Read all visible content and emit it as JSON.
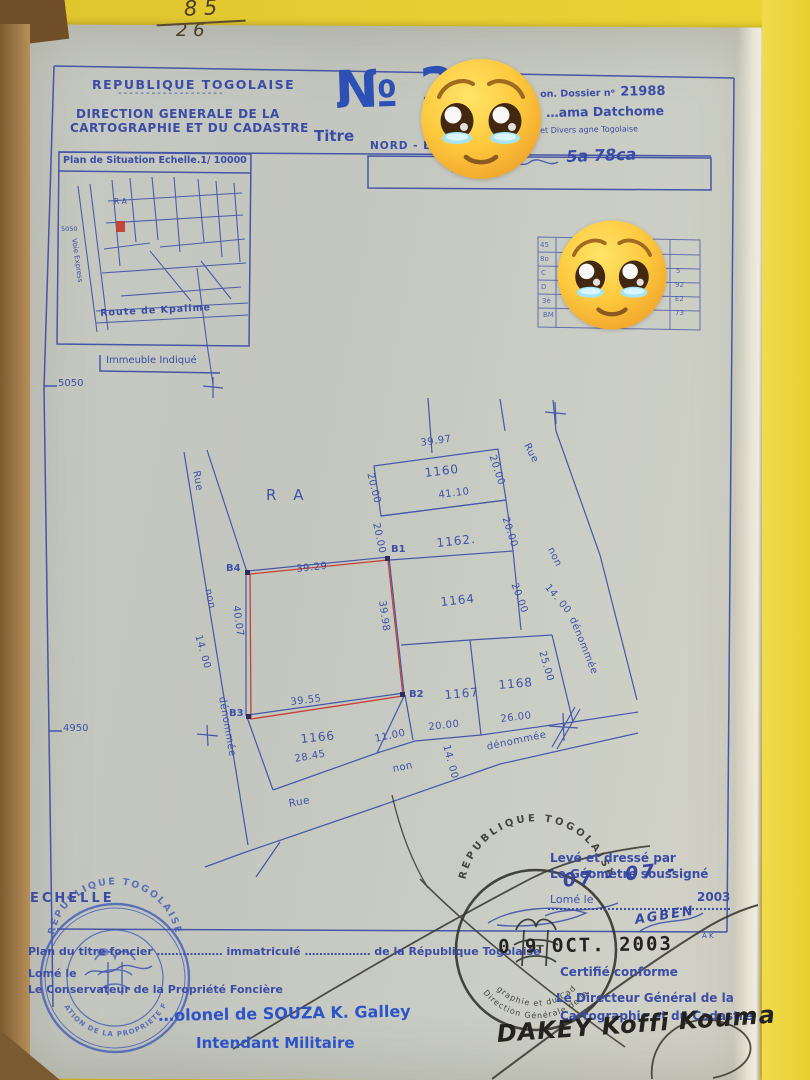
{
  "photo": {
    "note_line1": "8 5",
    "note_line2": "2 6"
  },
  "header": {
    "republic": "REPUBLIQUE  TOGOLAISE",
    "underline": "-------------------",
    "direction1": "DIRECTION  GENERALE  DE  LA",
    "direction2": "CARTOGRAPHIE  ET  DU  CADASTRE",
    "titre": "Titre",
    "number": "№ 2",
    "dossier_prefix": "on. Dossier nᵒ",
    "dossier_number": "21988",
    "holder_line": "…ama  Datchome",
    "holder_line2": "et Divers agne Togolaise",
    "nord": "NORD  -  EX",
    "surface": "5a 78ca"
  },
  "situation": {
    "title": "Plan de Situation Echelle.1/ 10000",
    "ra": "R A",
    "coord": "5050",
    "voie": "Voie Express",
    "route": "Route  de  Kpalime",
    "immeuble": "Immeuble  Indiqué"
  },
  "table": {
    "left": [
      "45",
      "8o",
      "C",
      "D",
      "3è",
      "BM"
    ],
    "right": [
      "5",
      "92",
      "E2",
      "73"
    ]
  },
  "plan": {
    "coord_top": "5050",
    "coord_bottom": "4950",
    "zone": "R A",
    "rue": "Rue",
    "non": "non",
    "denommee": "dénommée",
    "w14": "14. 00",
    "b1": "B1",
    "b2": "B2",
    "b3": "B3",
    "b4": "B4",
    "p1160": "1160",
    "p1162": "1162.",
    "p1164": "1164",
    "p1166": "1166",
    "p1167": "1167",
    "p1168": "1168",
    "d3997": "39.97",
    "d4110": "41.10",
    "d2000": "20.00",
    "d3929": "39.29",
    "d4007": "40.07",
    "d3998": "39.98",
    "d3955": "39.55",
    "d2845": "28.45",
    "d1100": "11.00",
    "d2500": "25.00",
    "d2600": "26.00"
  },
  "footer_left": {
    "echelle": "ECHELLE",
    "title_line": "Plan du titre foncier ………………  immatriculé ………………  de la République  Togolaise",
    "lome": "Lomé le",
    "conservateur": "Le Conservateur de la Propriété Foncière",
    "souza": "…olonel de SOUZA K. Galley",
    "intendant": "Intendant  Militaire"
  },
  "footer_right": {
    "leve1": "Levé et dressé par",
    "leve2": "Le Géomètre soussigné",
    "lome": "Lomé le",
    "date_hand": "07 - 07 -",
    "year": "2003",
    "sig": "AGBEN",
    "sig_initials": "A K",
    "date_stamp": "0 9 OCT.  2003",
    "certifie": "Certifié conforme",
    "dg1": "Le Directeur Général de la",
    "dg2": "Cartographie et du Cadastre",
    "dakey": "DAKEY  Koffi  Kouma"
  },
  "stamps": {
    "blue_top": "REPUBLIQUE TOGOLAISE",
    "blue_bottom": "CONSERVATION DE LA PROPRIETE FONCIERE",
    "black_top": "REPUBLIQUE TOGOLAISE",
    "black_mid": "Direction Générale de la",
    "black_bottom": "Cartographie et du Cadastre",
    "black_rt": "RT"
  },
  "stickers": {
    "emoji": "face-holding-back-tears-emoji"
  }
}
